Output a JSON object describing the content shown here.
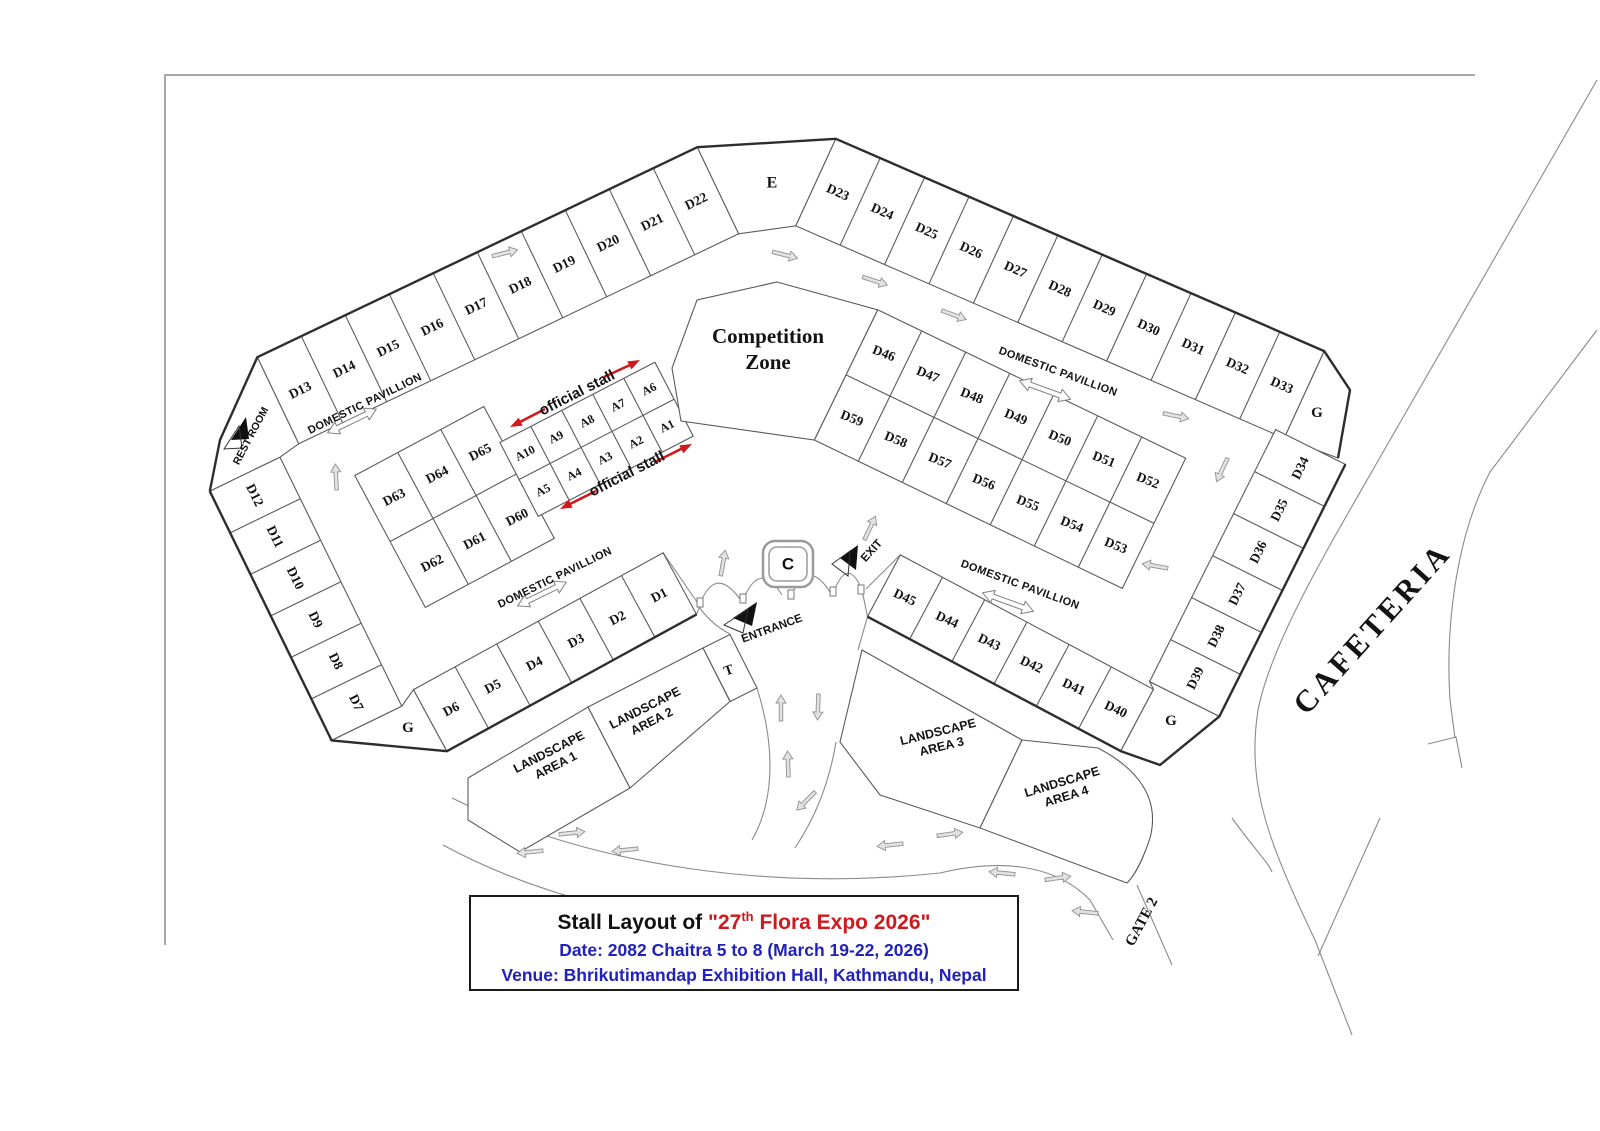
{
  "title_box": {
    "prefix": "Stall Layout of ",
    "expo_open": "\"27",
    "expo_sup": "th",
    "expo_rest": " Flora Expo 2026\"",
    "date_line": "Date: 2082 Chaitra 5 to 8 (March 19-22, 2026)",
    "venue_line": "Venue: Bhrikutimandap Exhibition Hall, Kathmandu, Nepal",
    "accent_red": "#d0191c",
    "accent_blue": "#2121bd"
  },
  "areas": {
    "competition1": "Competition",
    "competition2": "Zone",
    "cafeteria": "CAFETERIA",
    "gate2": "GATE 2",
    "rest_room": "REST ROOM",
    "entrance": "ENTRANCE",
    "exit": "EXIT",
    "landscape_word": "LANDSCAPE",
    "area1": "AREA 1",
    "area2": "AREA 2",
    "area3": "AREA 3",
    "area4": "AREA 4",
    "domestic_pavillion": "DOMESTIC PAVILLION",
    "official_stall": "official stall"
  },
  "stalls": {
    "arc_left": [
      "D13",
      "D14",
      "D15",
      "D16",
      "D17",
      "D18",
      "D19",
      "D20",
      "D21",
      "D22"
    ],
    "apex": "E",
    "arc_right": [
      "D23",
      "D24",
      "D25",
      "D26",
      "D27",
      "D28",
      "D29",
      "D30",
      "D31",
      "D32",
      "D33"
    ],
    "left_col": [
      "D12",
      "D11",
      "D10",
      "D9",
      "D8",
      "D7"
    ],
    "right_col": [
      "D34",
      "D35",
      "D36",
      "D37",
      "D38",
      "D39"
    ],
    "row_bl": [
      "D6",
      "D5",
      "D4",
      "D3",
      "D2",
      "D1"
    ],
    "row_br": [
      "D45",
      "D44",
      "D43",
      "D42",
      "D41",
      "D40"
    ],
    "block_right_top": [
      "D46",
      "D47",
      "D48",
      "D49",
      "D50",
      "D51",
      "D52"
    ],
    "block_right_bottom": [
      "D59",
      "D58",
      "D57",
      "D56",
      "D55",
      "D54",
      "D53"
    ],
    "block_center_top": [
      "D63",
      "D64",
      "D65"
    ],
    "block_center_bottom": [
      "D62",
      "D61",
      "D60"
    ],
    "a_top": [
      "A10",
      "A9",
      "A8",
      "A7",
      "A6"
    ],
    "a_bottom": [
      "A5",
      "A4",
      "A3",
      "A2",
      "A1"
    ],
    "g": "G",
    "t": "T",
    "c": "C"
  },
  "icons": {
    "direction_arrow": "single-outline-arrow",
    "two_way_arrow": "double-outline-arrow",
    "marker_triangle": "filled-flag-triangle"
  },
  "colors": {
    "line": "#5a5a5a",
    "heavy_line": "#2d2d2d",
    "arrow_red": "#d0191c"
  }
}
